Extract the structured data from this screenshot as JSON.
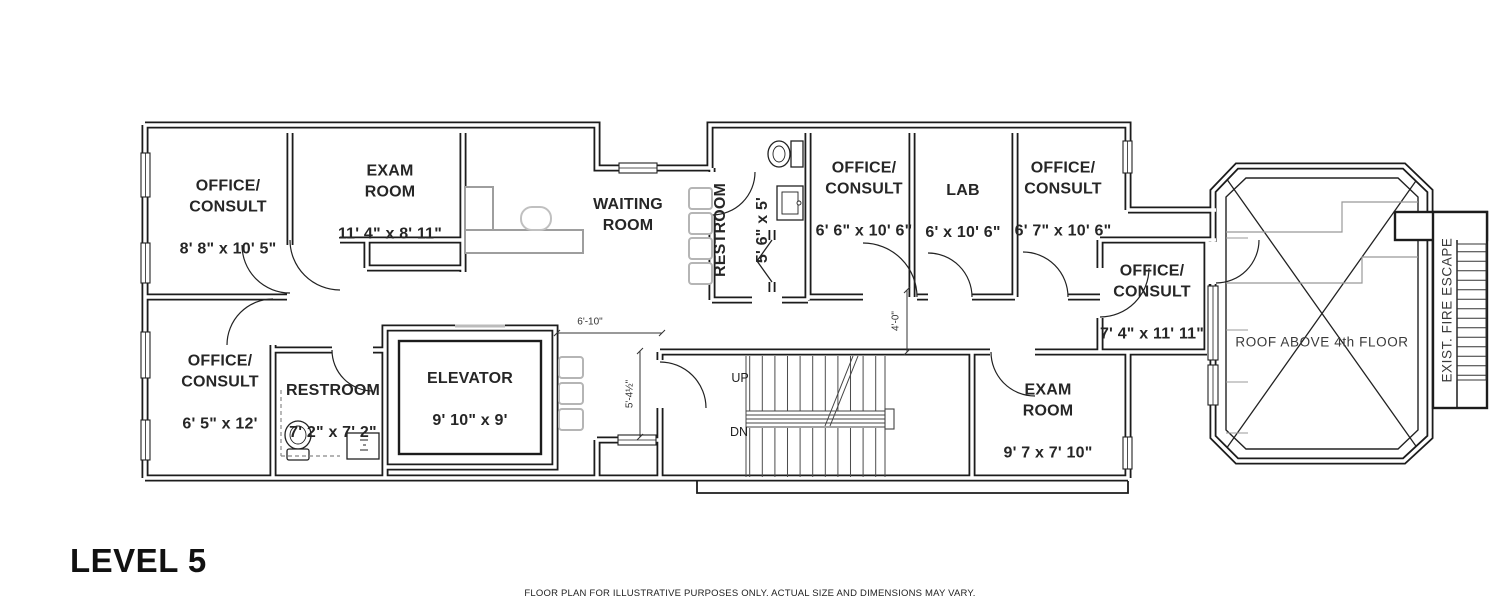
{
  "page": {
    "title": "LEVEL 5",
    "disclaimer": "FLOOR PLAN FOR ILLUSTRATIVE PURPOSES ONLY. ACTUAL SIZE AND DIMENSIONS MAY VARY."
  },
  "rooms": {
    "office1": {
      "name": "OFFICE/\nCONSULT",
      "dims": "8' 8\" x 10' 5\""
    },
    "exam1": {
      "name": "EXAM\nROOM",
      "dims": "11' 4\" x 8' 11\""
    },
    "waiting": {
      "name": "WAITING\nROOM",
      "dims": ""
    },
    "restroom1": {
      "name": "RESTROOM",
      "dims": "5' 6\" x 5'"
    },
    "office2": {
      "name": "OFFICE/\nCONSULT",
      "dims": "6' 6\" x 10' 6\""
    },
    "lab": {
      "name": "LAB",
      "dims": "6' x 10' 6\""
    },
    "office3": {
      "name": "OFFICE/\nCONSULT",
      "dims": "6' 7\" x 10' 6\""
    },
    "office4": {
      "name": "OFFICE/\nCONSULT",
      "dims": "7' 4\" x 11' 11\""
    },
    "office5": {
      "name": "OFFICE/\nCONSULT",
      "dims": "6' 5\" x 12'"
    },
    "restroom2": {
      "name": "RESTROOM",
      "dims": "7' 2\" x 7' 2\""
    },
    "elevator": {
      "name": "ELEVATOR",
      "dims": "9' 10\" x 9'"
    },
    "exam2": {
      "name": "EXAM\nROOM",
      "dims": "9' 7 x 7' 10\""
    }
  },
  "annotations": {
    "roof": "ROOF ABOVE 4th FLOOR",
    "fire_escape": "EXIST. FIRE ESCAPE",
    "up": "UP",
    "dn": "DN"
  },
  "dimensions": {
    "d1": "6'-10\"",
    "d2": "5'-4½\"",
    "d3": "4'-0\""
  },
  "colors": {
    "wall": "#1c1c1c",
    "text": "#262626",
    "furniture": "#b5b5b5",
    "hatch": "#999999"
  }
}
